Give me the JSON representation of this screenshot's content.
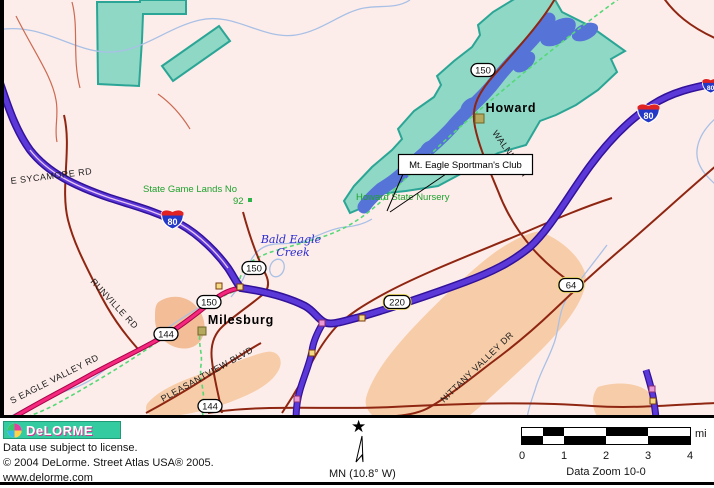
{
  "map": {
    "towns": {
      "howard": "Howard",
      "milesburg": "Milesburg"
    },
    "callout": {
      "label": "Mt. Eagle Sportman's Club"
    },
    "areas": {
      "game_lands_name": "State Game Lands No",
      "game_lands_number": "92",
      "nursery": "Howard State Nursery"
    },
    "water": {
      "creek_name_line1": "Bald Eagle",
      "creek_name_line2": "Creek"
    },
    "roads": {
      "sycamore": "E SYCAMORE RD",
      "runville": "RUNVILLE RD",
      "eagle_valley": "S EAGLE VALLEY RD",
      "pleasantview": "PLEASANTVIEW BLVD",
      "nittany": "NITTANY VALLEY DR",
      "walnut": "WALNUT ST"
    },
    "shields": {
      "interstate_80": "80",
      "route_150": "150",
      "route_144": "144",
      "route_220": "220",
      "route_64": "64"
    }
  },
  "footer": {
    "logo_text": "DeLORME",
    "license": "Data use subject to license.",
    "copyright": "© 2004 DeLorme. Street Atlas USA® 2005.",
    "website": "www.delorme.com",
    "compass_label": "MN (10.8° W)",
    "scale": {
      "ticks": [
        "0",
        "1",
        "2",
        "3",
        "4"
      ],
      "unit": "mi",
      "zoom_label": "Data Zoom 10-0"
    }
  },
  "colors": {
    "map_background": "#fdedea",
    "interstate_purple": "#5b38d8",
    "state_route_pink": "#f5277e",
    "major_road_red": "#8f2612",
    "park_teal": "#8ed8c5",
    "lake_blue": "#5673d8",
    "builtup_salmon": "#f7cda9",
    "railroad_green": "#55d877",
    "water_label_blue": "#2a2ad0",
    "landmark_green": "#1ea12e",
    "logo_teal": "#35cba0"
  }
}
